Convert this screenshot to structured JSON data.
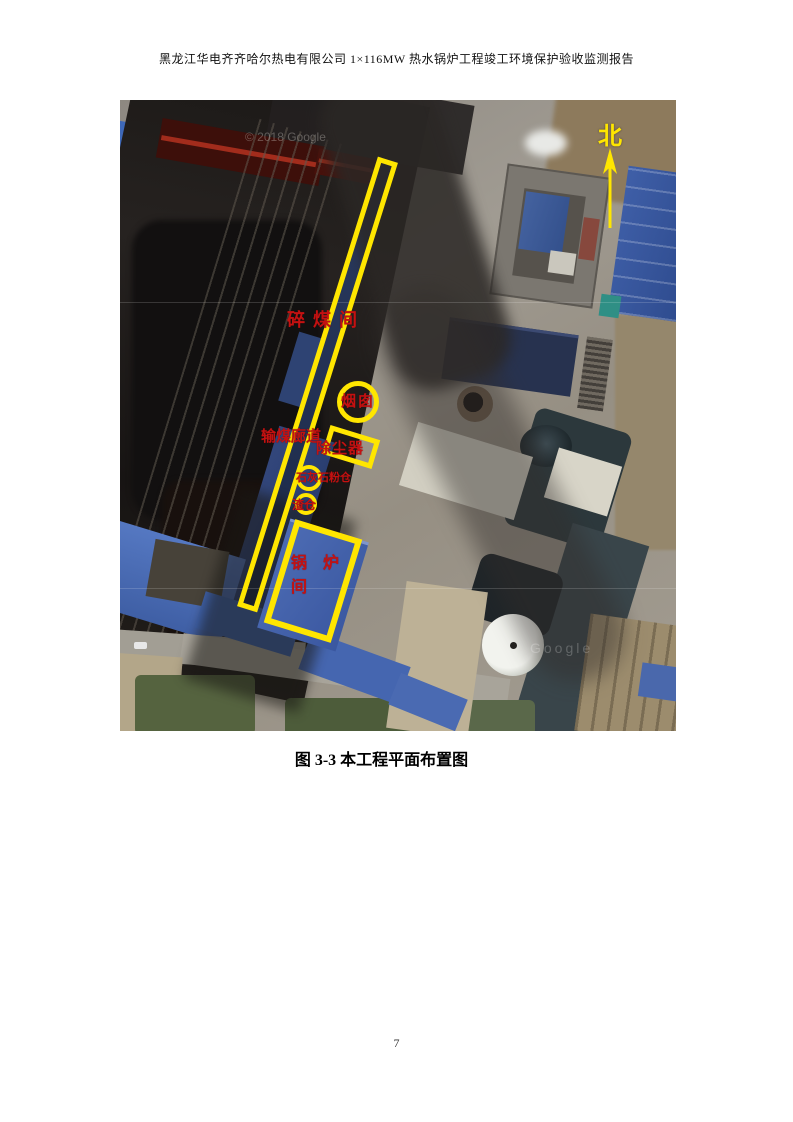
{
  "header": {
    "title": "黑龙江华电齐齐哈尔热电有限公司 1×116MW 热水锅炉工程竣工环境保护验收监测报告"
  },
  "figure": {
    "caption": "图 3-3  本工程平面布置图",
    "north_label": "北",
    "watermarks": {
      "top_left": "© 2018 Google",
      "center": "Google"
    },
    "annotations": {
      "crusher_room": "碎煤间",
      "stack": "烟囱",
      "coal_conveyor_corridor": "输煤廊道",
      "dust_collector": "除尘器",
      "limestone_silo": "石灰石粉仓",
      "slag_silo": "渣仓",
      "boiler_room_line1": "锅　炉",
      "boiler_room_line2": "间"
    },
    "colors": {
      "annotation_yellow": "#ffe600",
      "label_red": "#c41111"
    }
  },
  "footer": {
    "page_number": "7"
  }
}
